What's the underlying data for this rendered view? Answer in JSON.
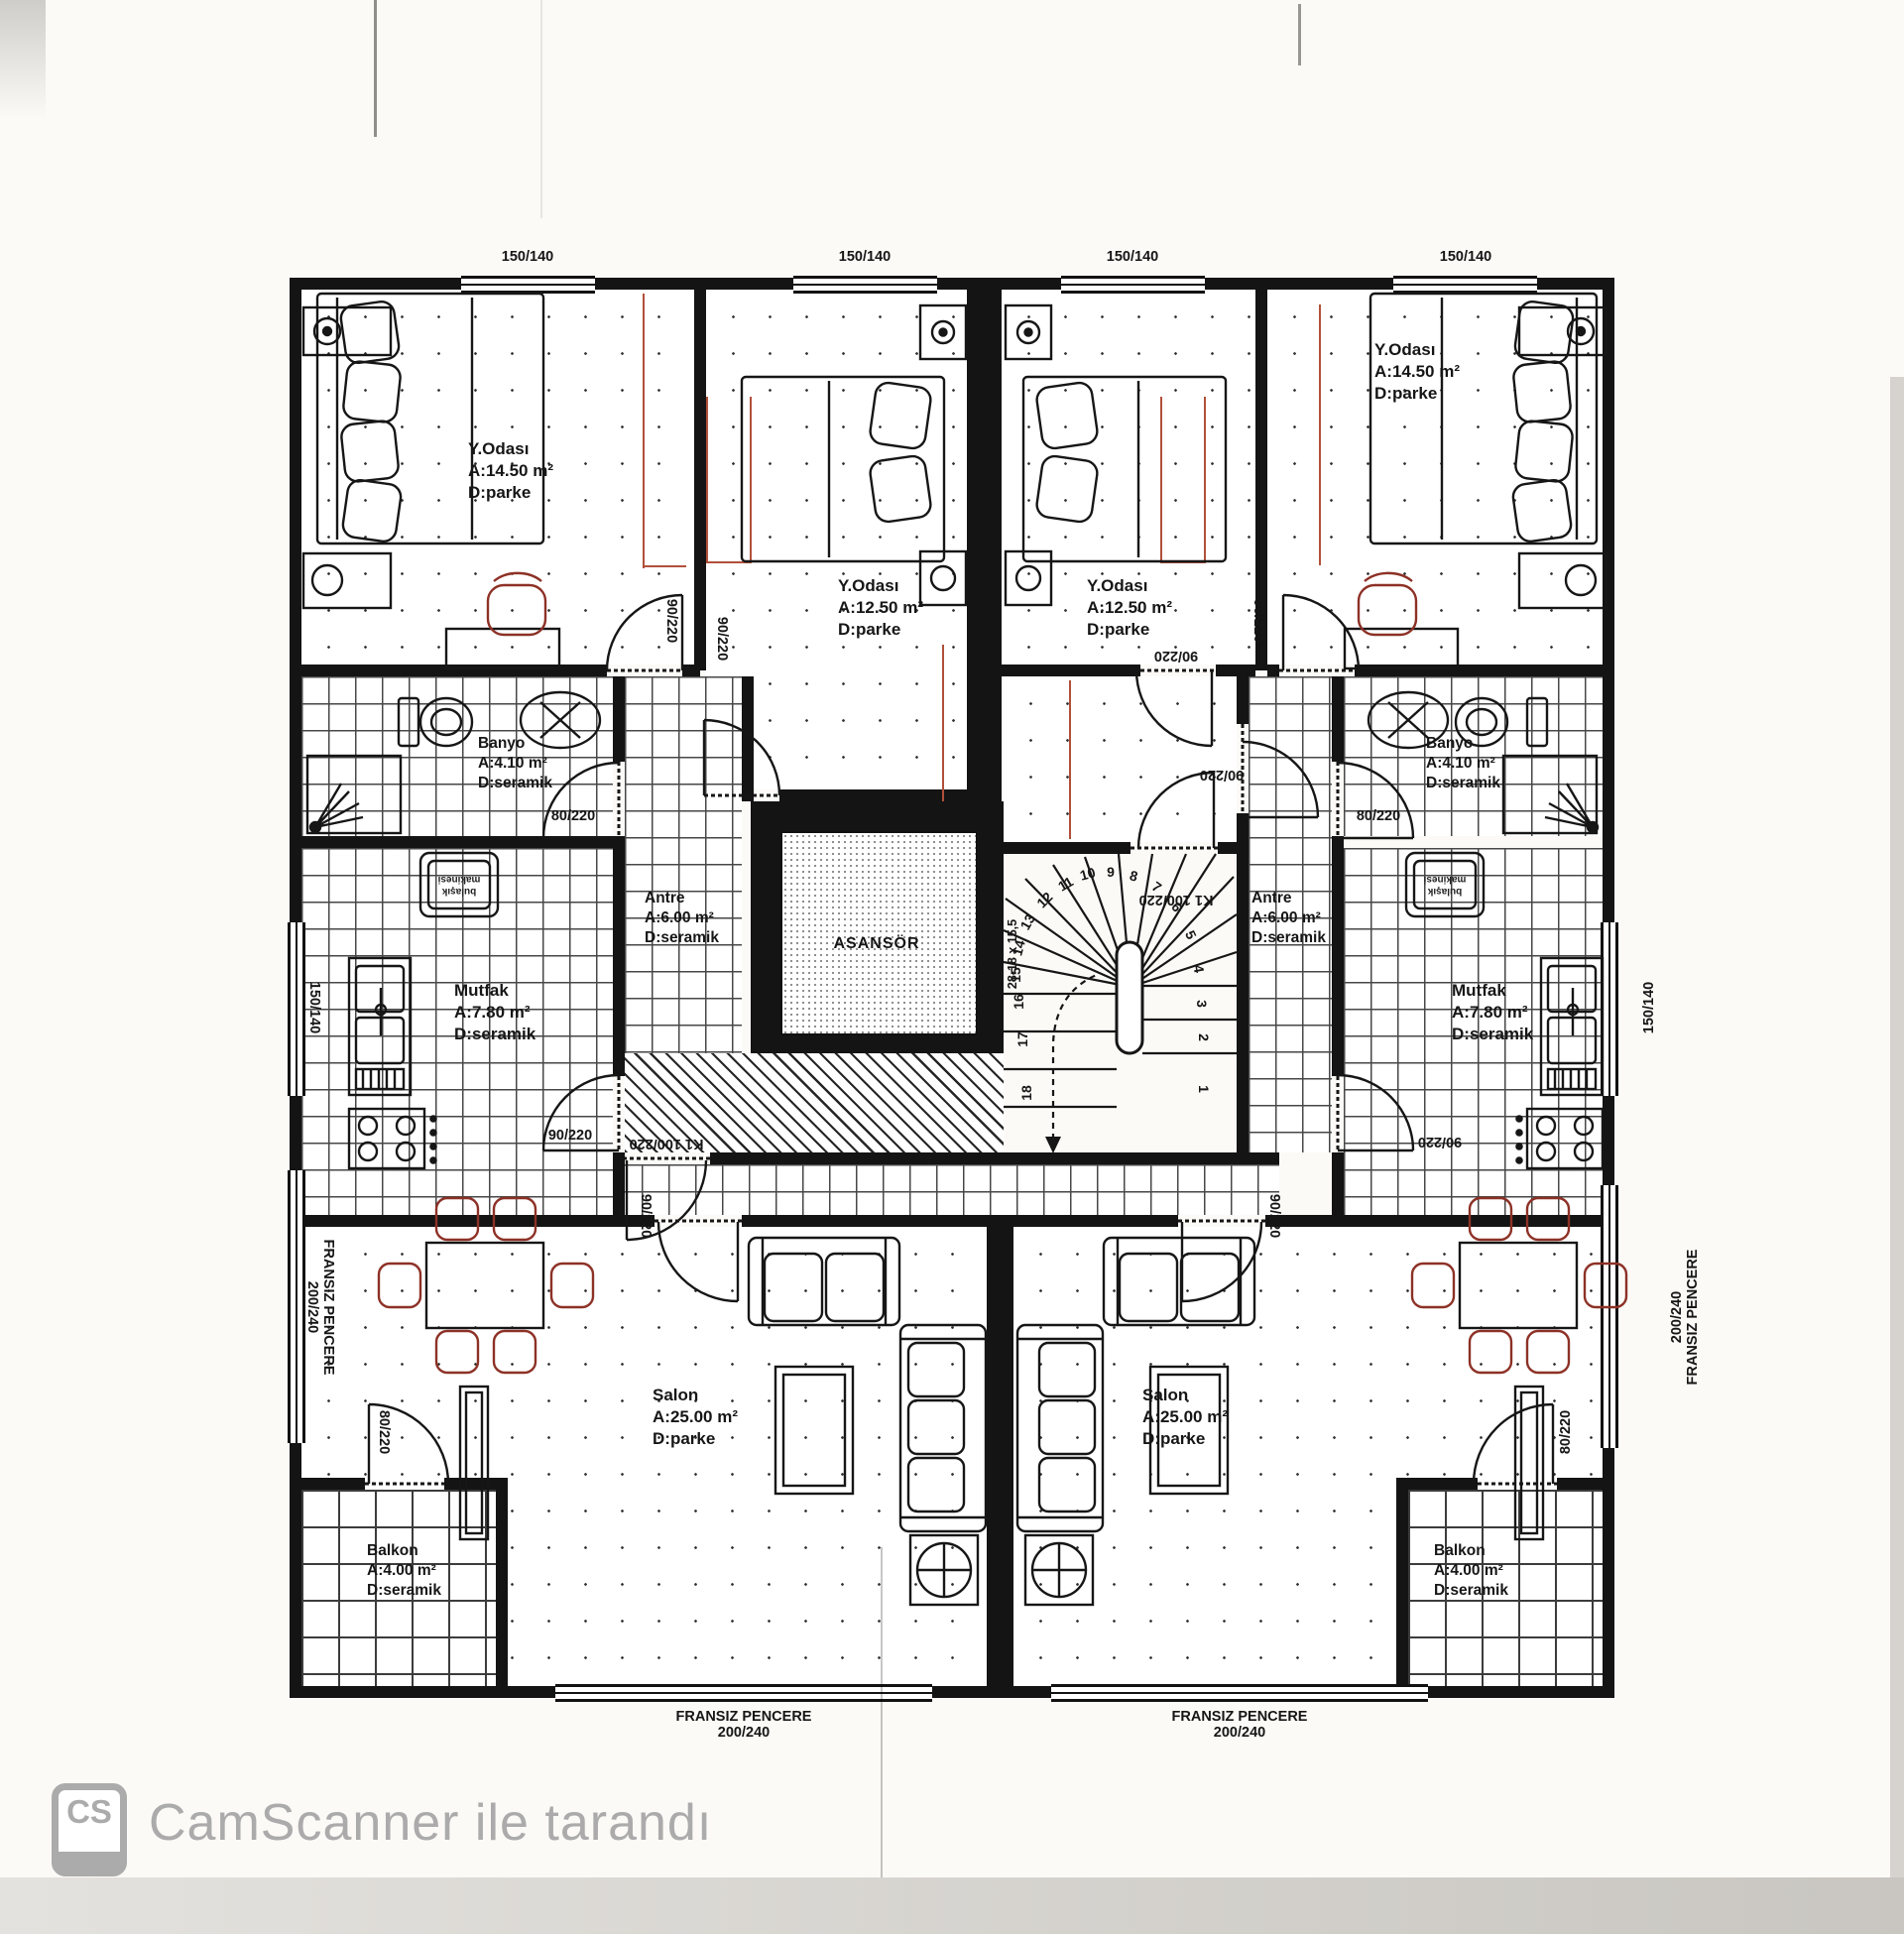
{
  "rooms": [
    {
      "name": "Y.Odası",
      "area": "A:14.50 m²",
      "floor": "D:parke"
    },
    {
      "name": "Y.Odası",
      "area": "A:12.50 m²",
      "floor": "D:parke"
    },
    {
      "name": "Y.Odası",
      "area": "A:12.50 m²",
      "floor": "D:parke"
    },
    {
      "name": "Y.Odası",
      "area": "A:14.50 m²",
      "floor": "D:parke"
    },
    {
      "name": "Banyo",
      "area": "A:4.10 m²",
      "floor": "D:seramik"
    },
    {
      "name": "Banyo",
      "area": "A:4.10 m²",
      "floor": "D:seramik"
    },
    {
      "name": "Mutfak",
      "area": "A:7.80 m²",
      "floor": "D:seramik"
    },
    {
      "name": "Mutfak",
      "area": "A:7.80 m²",
      "floor": "D:seramik"
    },
    {
      "name": "Antre",
      "area": "A:6.00 m²",
      "floor": "D:seramik"
    },
    {
      "name": "Antre",
      "area": "A:6.00 m²",
      "floor": "D:seramik"
    },
    {
      "name": "Salon",
      "area": "A:25.00 m²",
      "floor": "D:parke"
    },
    {
      "name": "Salon",
      "area": "A:25.00 m²",
      "floor": "D:parke"
    },
    {
      "name": "Balkon",
      "area": "A:4.00 m²",
      "floor": "D:seramik"
    },
    {
      "name": "Balkon",
      "area": "A:4.00 m²",
      "floor": "D:seramik"
    }
  ],
  "elevator": {
    "label": "ASANSÖR"
  },
  "dims": {
    "d90": "90/220",
    "d80": "80/220",
    "k1": "K1 100/220",
    "w150": "150/140",
    "fp1": "FRANSIZ PENCERE",
    "fp2": "200/240"
  },
  "appliances": {
    "dishwasher": "bulaşık makinesi"
  },
  "stairs": {
    "note": "28-18 x 15,5",
    "numbers": [
      "1",
      "2",
      "3",
      "4",
      "5",
      "6",
      "7",
      "8",
      "9",
      "10",
      "11",
      "12",
      "13",
      "14",
      "15",
      "16",
      "17",
      "18"
    ]
  },
  "watermark": {
    "logo": "CS",
    "text": "CamScanner ile tarandı"
  }
}
